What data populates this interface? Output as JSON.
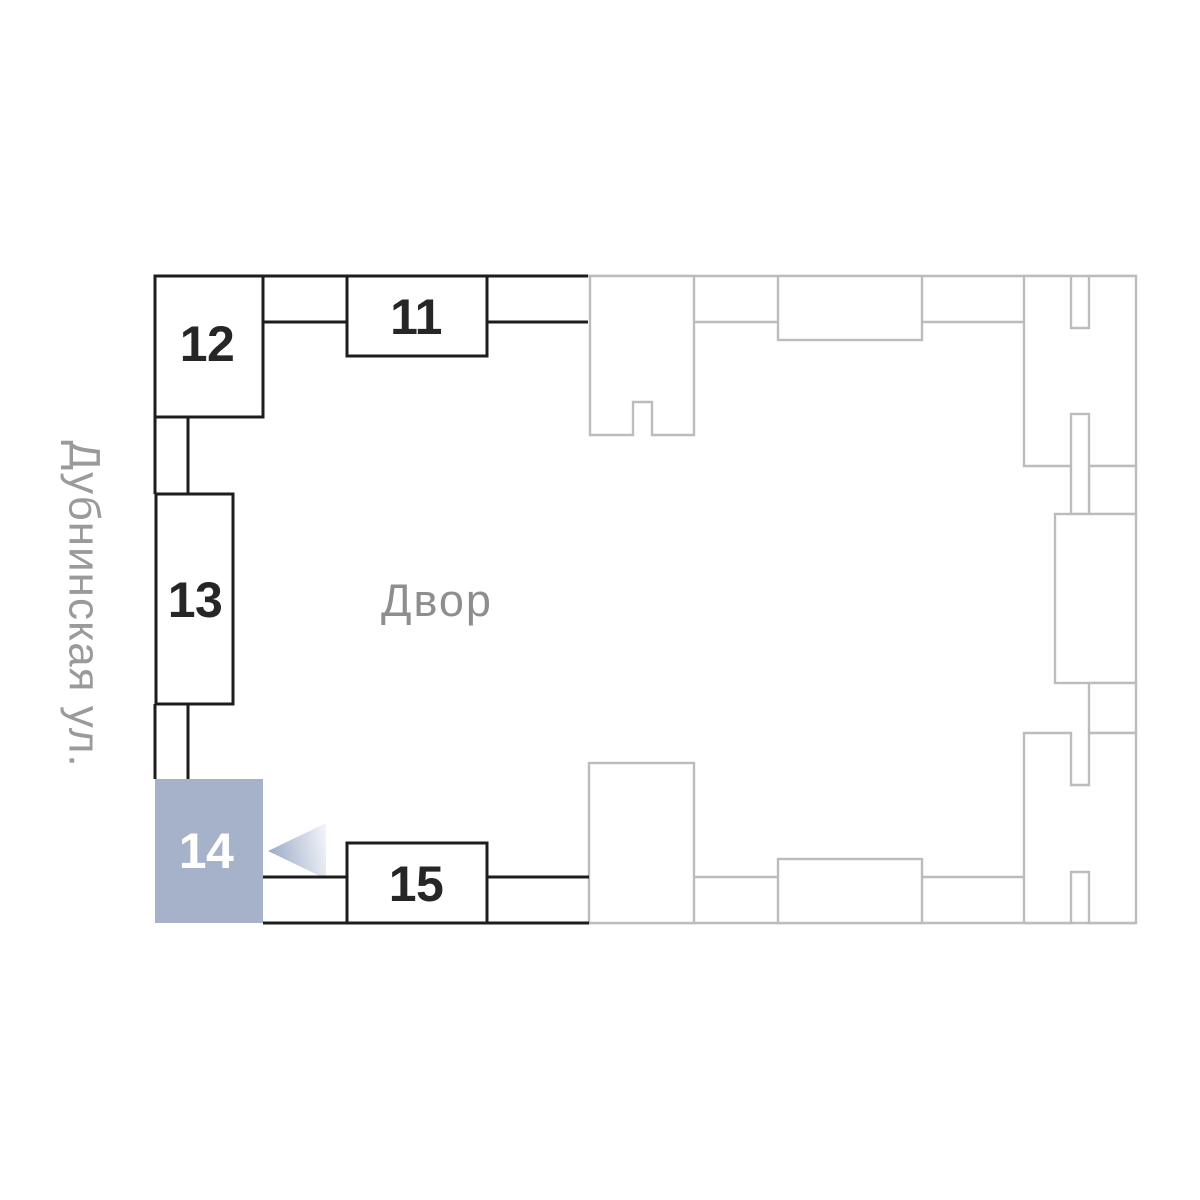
{
  "plan": {
    "street_label": "Дубнинская ул.",
    "courtyard_label": "Двор",
    "selected_building": "14",
    "buildings": [
      {
        "label": "11",
        "selected": false
      },
      {
        "label": "12",
        "selected": false
      },
      {
        "label": "13",
        "selected": false
      },
      {
        "label": "14",
        "selected": true
      },
      {
        "label": "15",
        "selected": false
      }
    ],
    "colors": {
      "dark_outline": "#1d1d1d",
      "light_outline": "#bcbcbc",
      "highlight_fill": "#a6b2ca",
      "dark_label": "#262626",
      "highlight_label": "#ffffff",
      "courtyard_text": "#8e8e8e",
      "street_text": "#9a9a9a",
      "arrow_start": "#9dabc6",
      "arrow_end": "#f4f7fb"
    }
  }
}
